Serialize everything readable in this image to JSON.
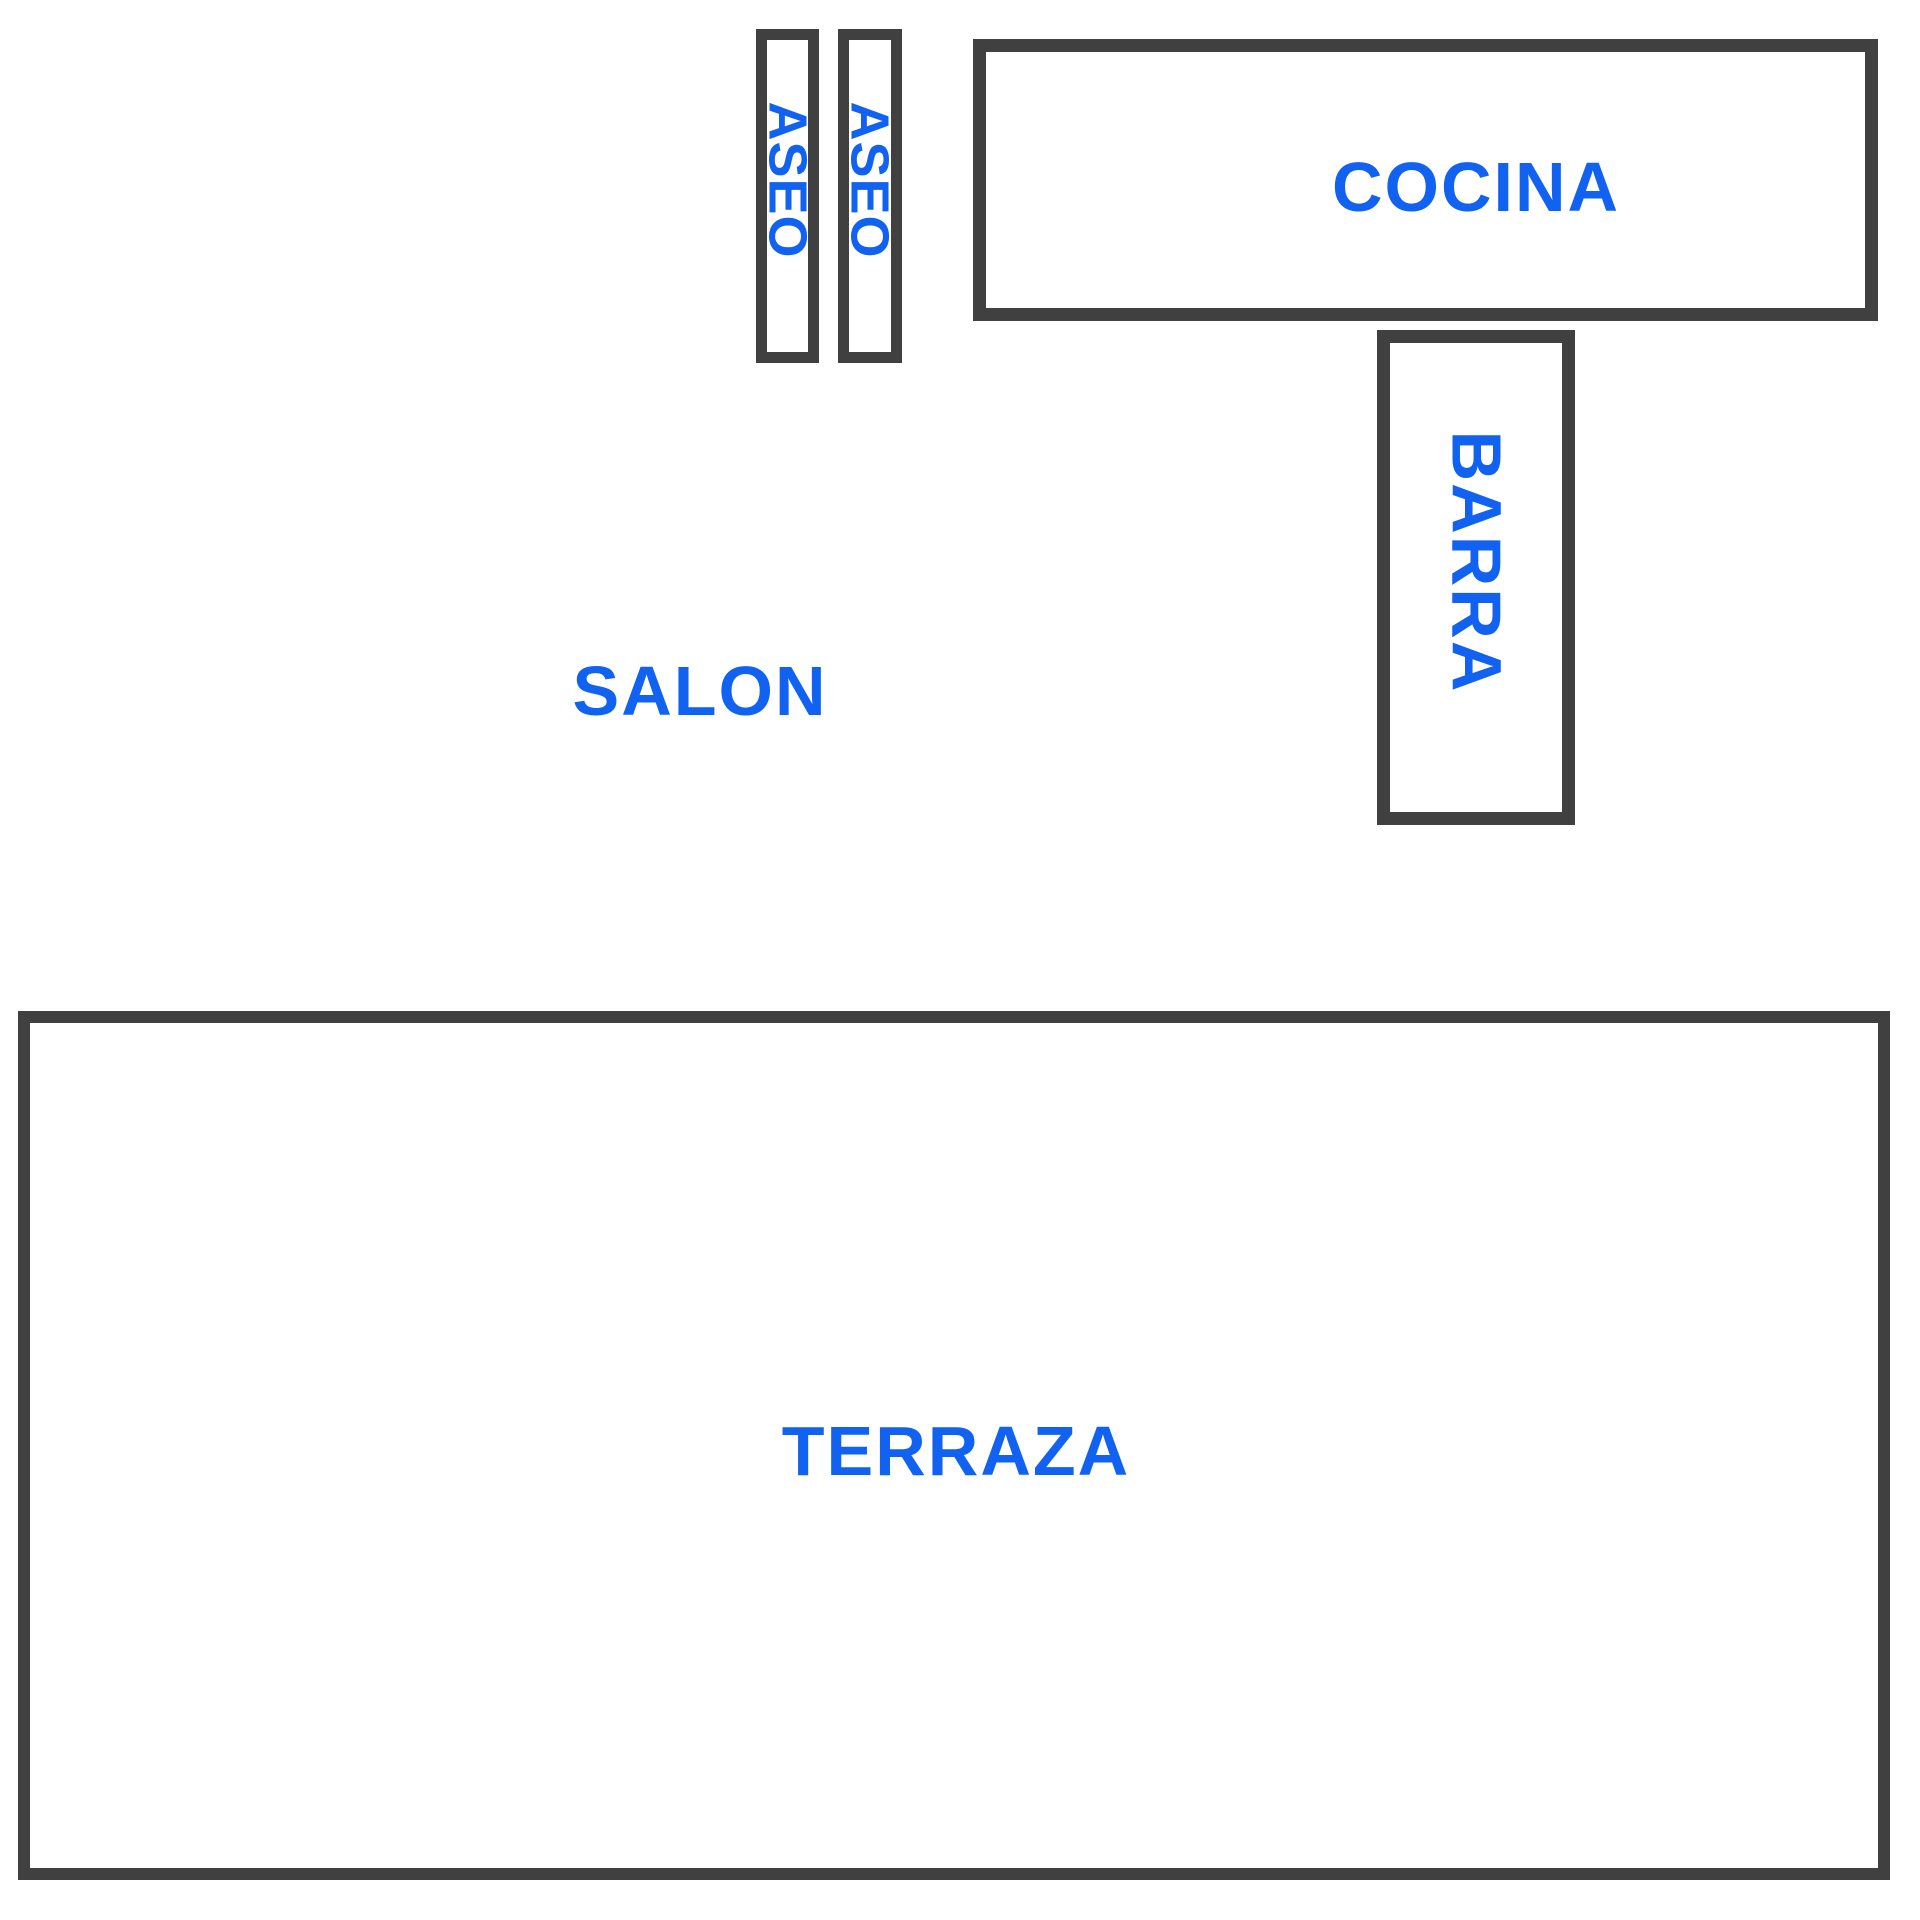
{
  "diagram": {
    "type": "floor-plan",
    "background": "#ffffff",
    "colors": {
      "room_outline": "#404040",
      "label_text": "#1162f0"
    },
    "rooms": [
      {
        "id": "aseo-1",
        "label": "ASEO",
        "label_orientation": "vertical",
        "outlined": true
      },
      {
        "id": "aseo-2",
        "label": "ASEO",
        "label_orientation": "vertical",
        "outlined": true
      },
      {
        "id": "cocina",
        "label": "COCINA",
        "label_orientation": "horizontal",
        "outlined": true
      },
      {
        "id": "barra",
        "label": "BARRA",
        "label_orientation": "vertical",
        "outlined": true
      },
      {
        "id": "salon",
        "label": "SALON",
        "label_orientation": "horizontal",
        "outlined": false
      },
      {
        "id": "terraza",
        "label": "TERRAZA",
        "label_orientation": "horizontal",
        "outlined": true
      }
    ]
  }
}
